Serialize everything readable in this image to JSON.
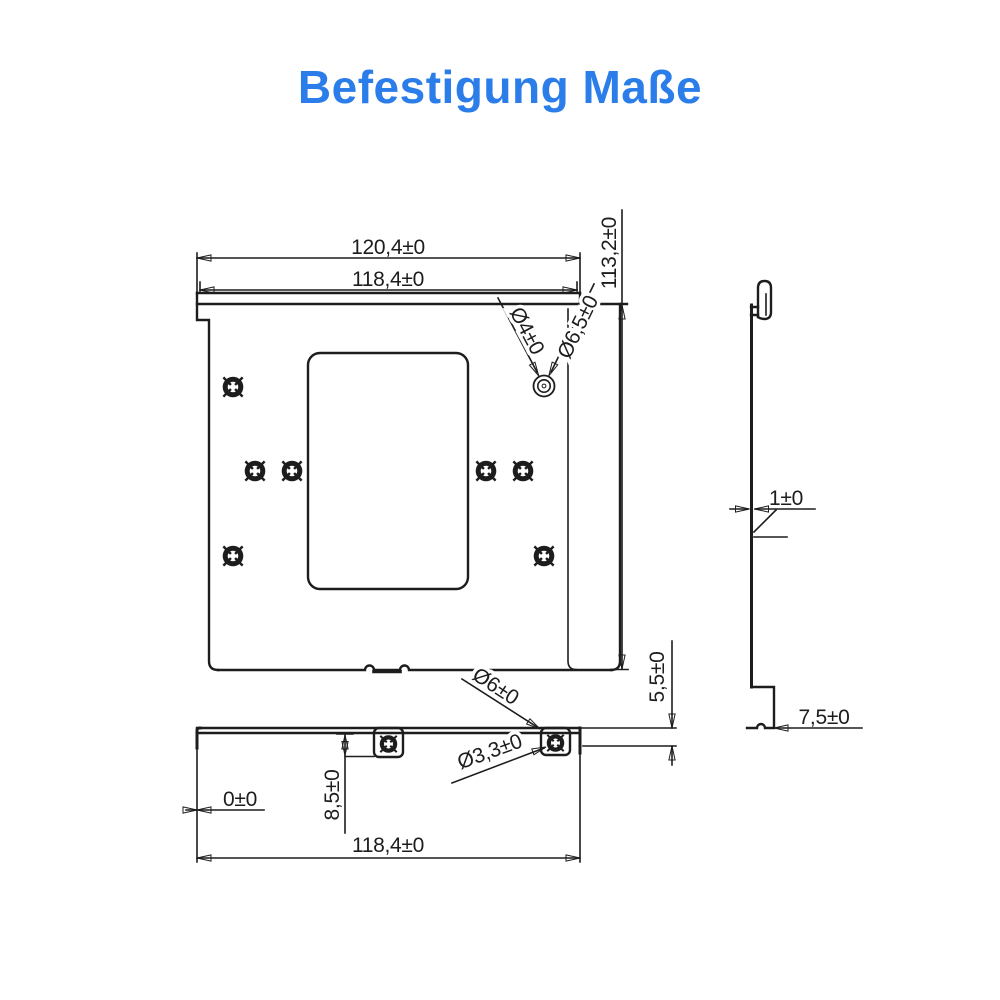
{
  "title": {
    "text": "Befestigung Maße",
    "color": "#2b7de9"
  },
  "colors": {
    "line": "#1d1d1d",
    "background": "#ffffff",
    "accent": "#2b7de9"
  },
  "dimensions": {
    "front": {
      "overall_width": "120,4±0",
      "body_width": "118,4±0",
      "height": "113,2±0",
      "corner_hole_inner": "Ø4±0",
      "corner_hole_outer": "Ø6,5±0"
    },
    "side": {
      "thickness": "1±0",
      "foot_width": "7,5±0"
    },
    "bottom": {
      "flush_offset": "0±0",
      "tab_offset": "8,5±0",
      "width": "118,4±0",
      "grommet_outer": "Ø6±0",
      "grommet_inner": "Ø3,3±0",
      "tab_height": "5,5±0"
    }
  }
}
